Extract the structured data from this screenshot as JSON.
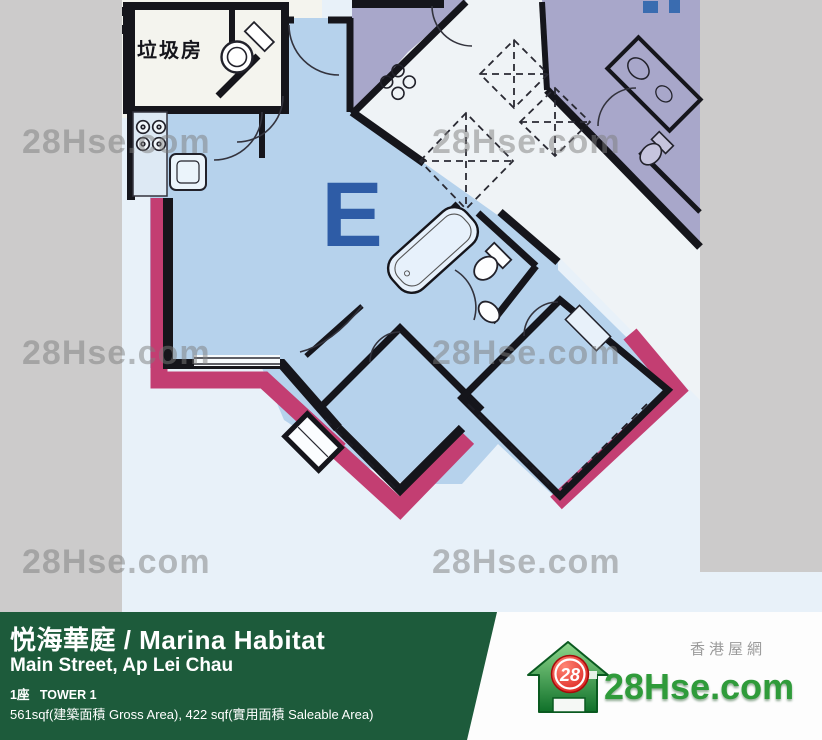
{
  "watermark": {
    "text": "28Hse.com"
  },
  "floor_plan": {
    "unit_label": "E",
    "garbage_room_label": "垃圾房",
    "colors": {
      "room_blue": "#b6d2ec",
      "neighbor_purple": "#a8a7ca",
      "highlight_pink": "#c33e72",
      "wall_black": "#15151b",
      "unit_letter_blue": "#2e5ca6",
      "scan_background": "#e8f1f9",
      "page_background": "#cccbcb"
    }
  },
  "banner": {
    "title": "悦海華庭 / Marina Habitat",
    "address": "Main Street, Ap Lei Chau",
    "tower": "1座   TOWER 1",
    "area": "561sqf(建築面積 Gross Area), 422 sqf(實用面積 Saleable Area)",
    "bg_color": "#1d5b3b"
  },
  "logo": {
    "site_cn": "香港屋網",
    "site_name": "28Hse.com",
    "badge": "28",
    "green": "#2f9b3a"
  }
}
